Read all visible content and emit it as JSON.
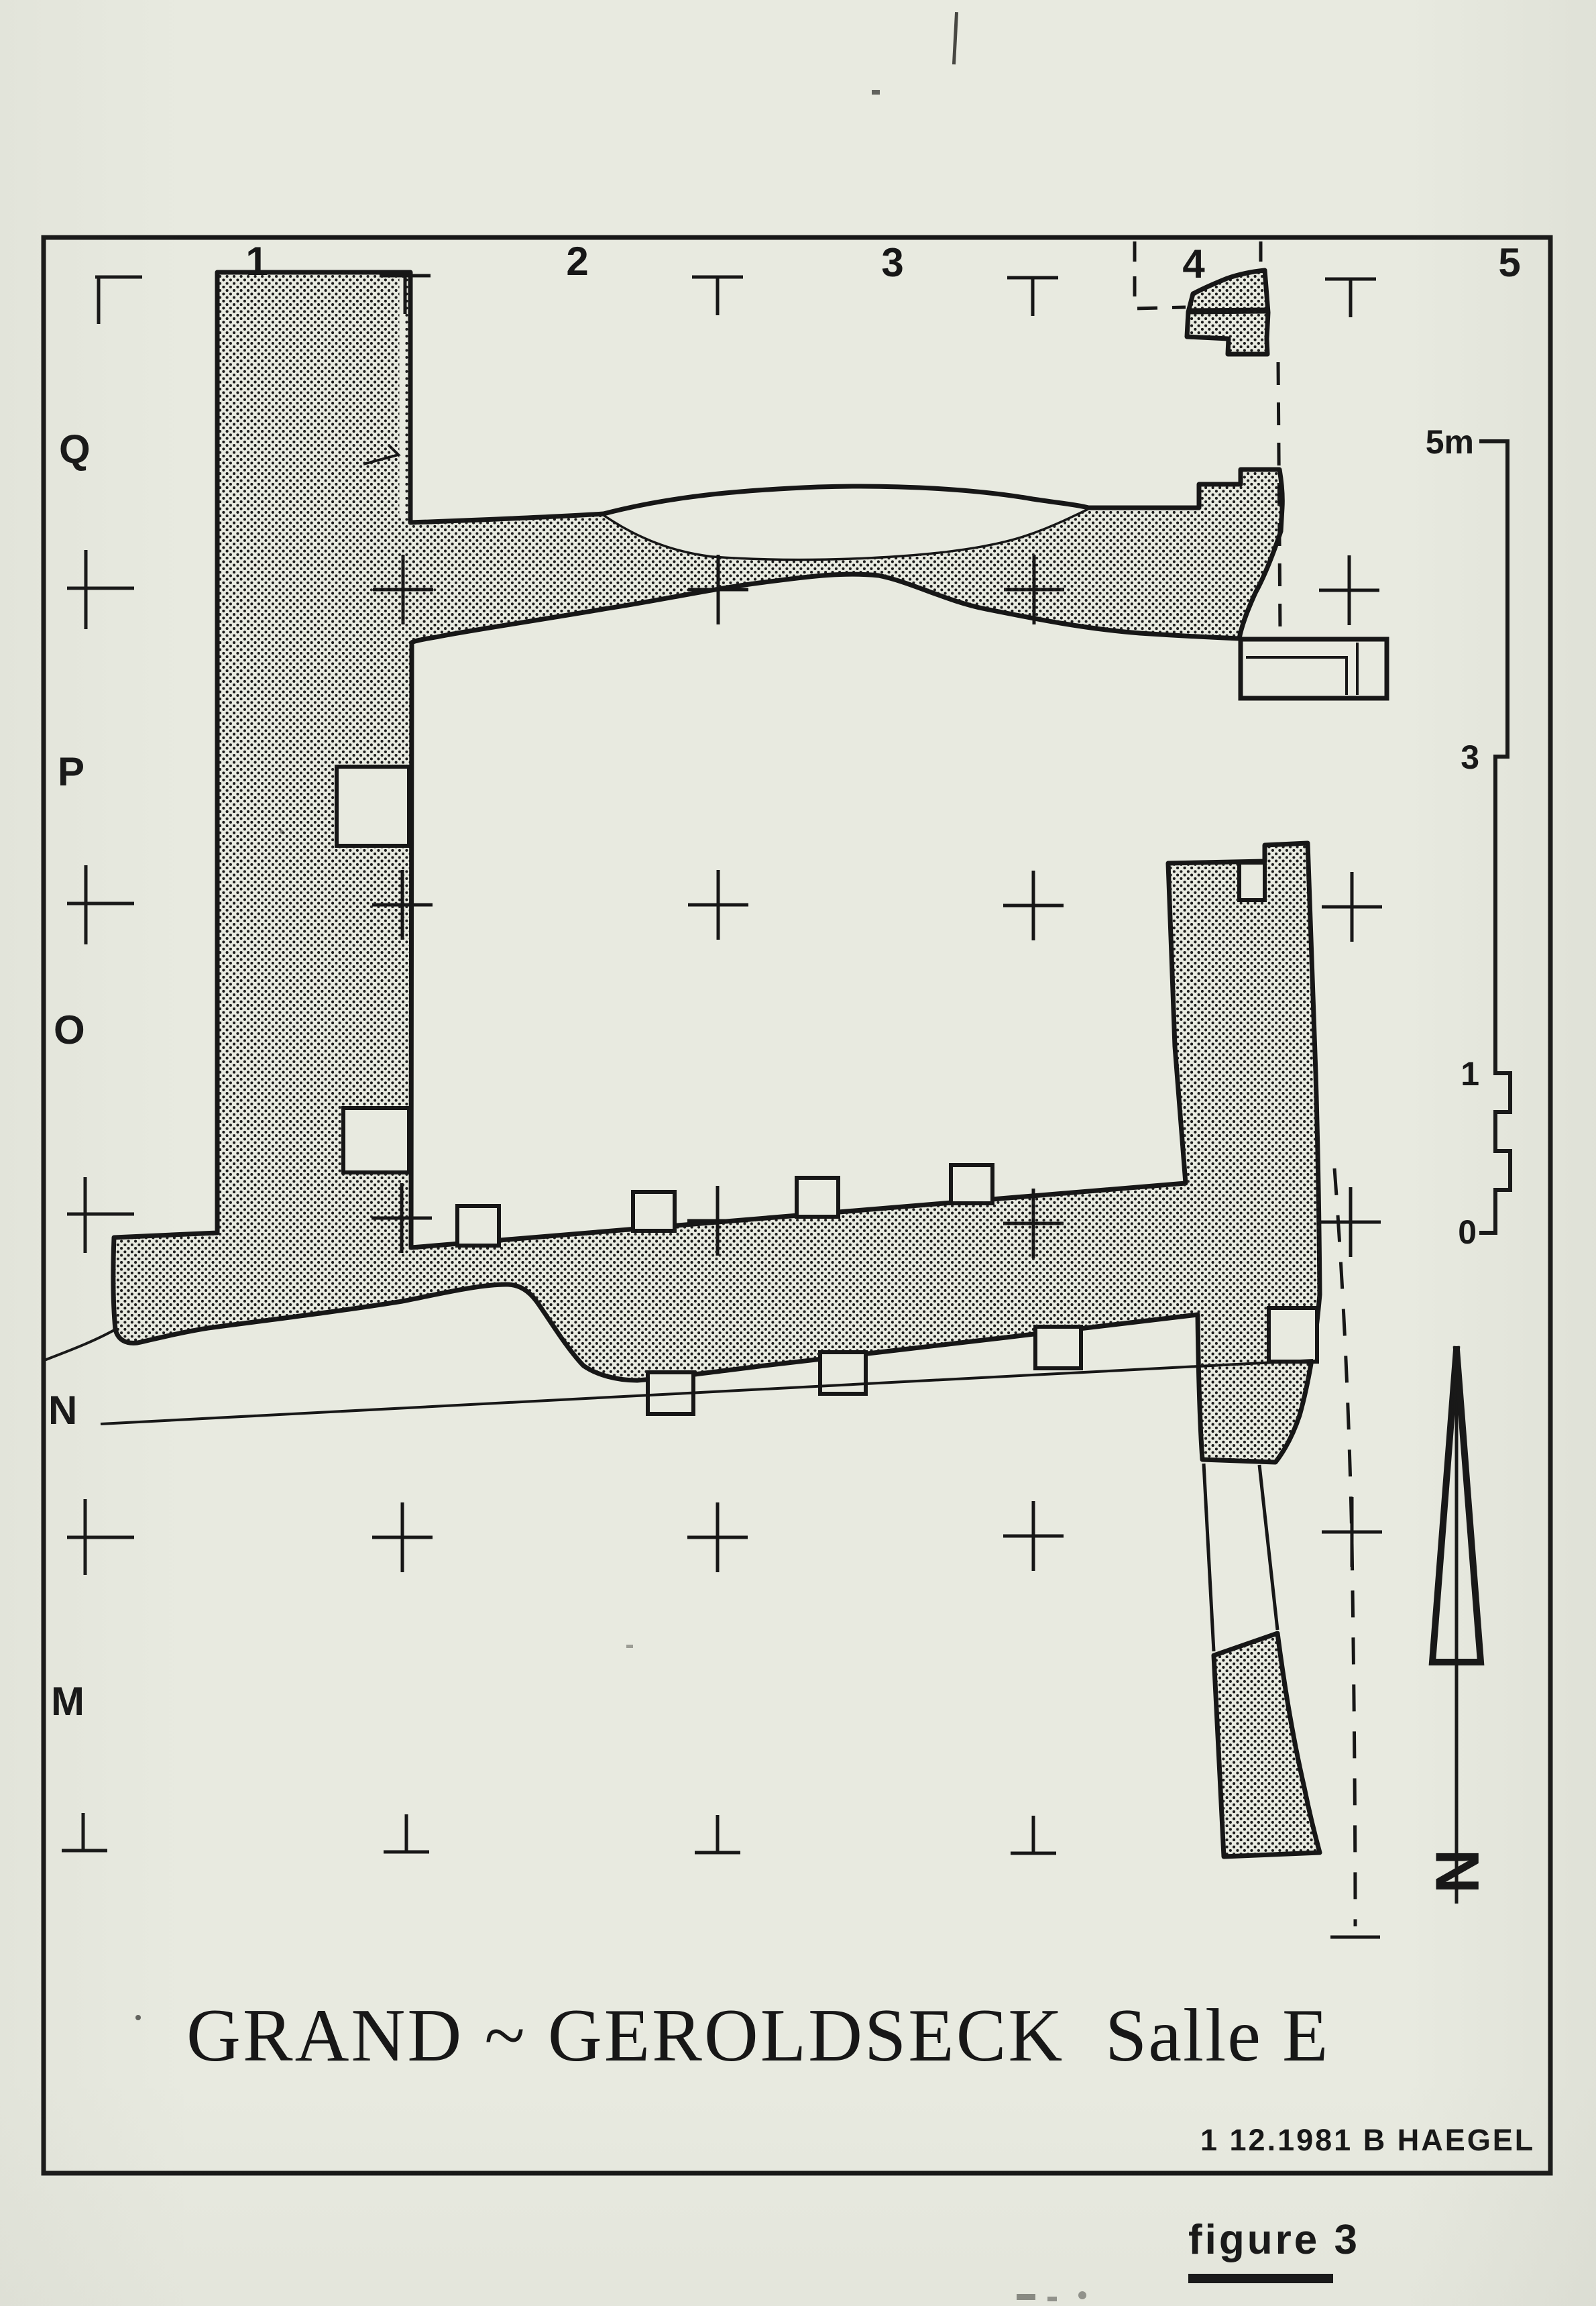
{
  "figure": {
    "title_main": "GRAND ~ GEROLDSECK",
    "title_room": "Salle E",
    "signature": "1 12.1981 B HAEGEL",
    "caption": "figure 3"
  },
  "grid": {
    "column_labels": [
      "1",
      "2",
      "3",
      "4",
      "5"
    ],
    "row_labels": [
      "Q",
      "P",
      "O",
      "N",
      "M"
    ]
  },
  "scale_bar": {
    "unit": "m",
    "max_label": "5m",
    "mid_label": "3",
    "one_label": "1",
    "zero_label": "0"
  },
  "north_arrow": {
    "label": "N"
  },
  "colors": {
    "paper": "#e8eae0",
    "ink": "#171717"
  }
}
